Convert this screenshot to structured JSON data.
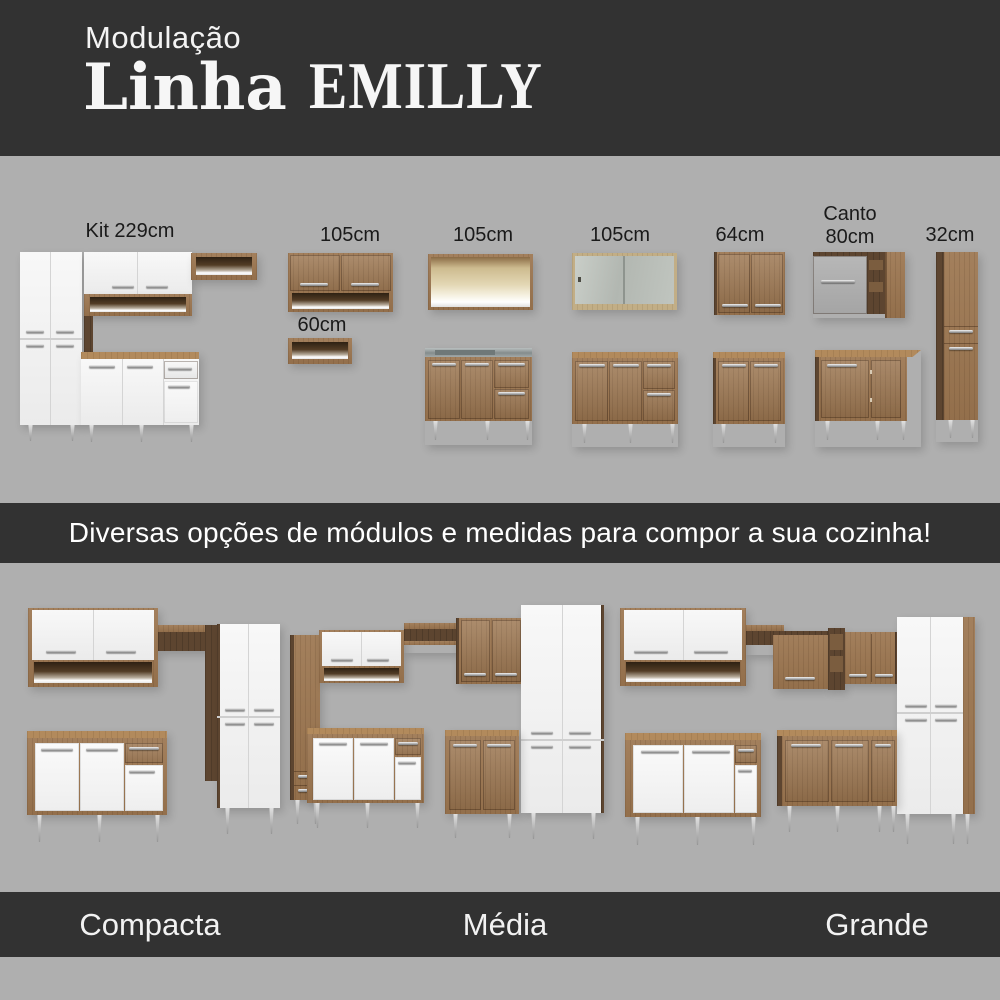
{
  "header": {
    "kicker": "Modulação",
    "title": "Linha",
    "title_accent": "EMILLY"
  },
  "modules": {
    "kit": {
      "label": "Kit 229cm"
    },
    "wall105_niche": {
      "label": "105cm"
    },
    "niche60": {
      "label": "60cm"
    },
    "wall105_open": {
      "label": "105cm"
    },
    "wall105_glass": {
      "label": "105cm"
    },
    "wall64": {
      "label": "64cm"
    },
    "corner80": {
      "label_line1": "Canto",
      "label_line2": "80cm"
    },
    "tall32": {
      "label": "32cm"
    }
  },
  "banner": {
    "text": "Diversas opções de módulos e medidas para compor a sua cozinha!"
  },
  "kitchens": {
    "compacta": {
      "label": "Compacta"
    },
    "media": {
      "label": "Média"
    },
    "grande": {
      "label": "Grande"
    }
  },
  "colors": {
    "band_dark": "#323232",
    "background_gray": "#afafaf",
    "wood_front": "#9c7650",
    "wood_dark_side": "#5d4530",
    "white_furniture": "#f4f4f4",
    "label_text": "#1a1a1a",
    "light_text": "#f2f2f2"
  }
}
